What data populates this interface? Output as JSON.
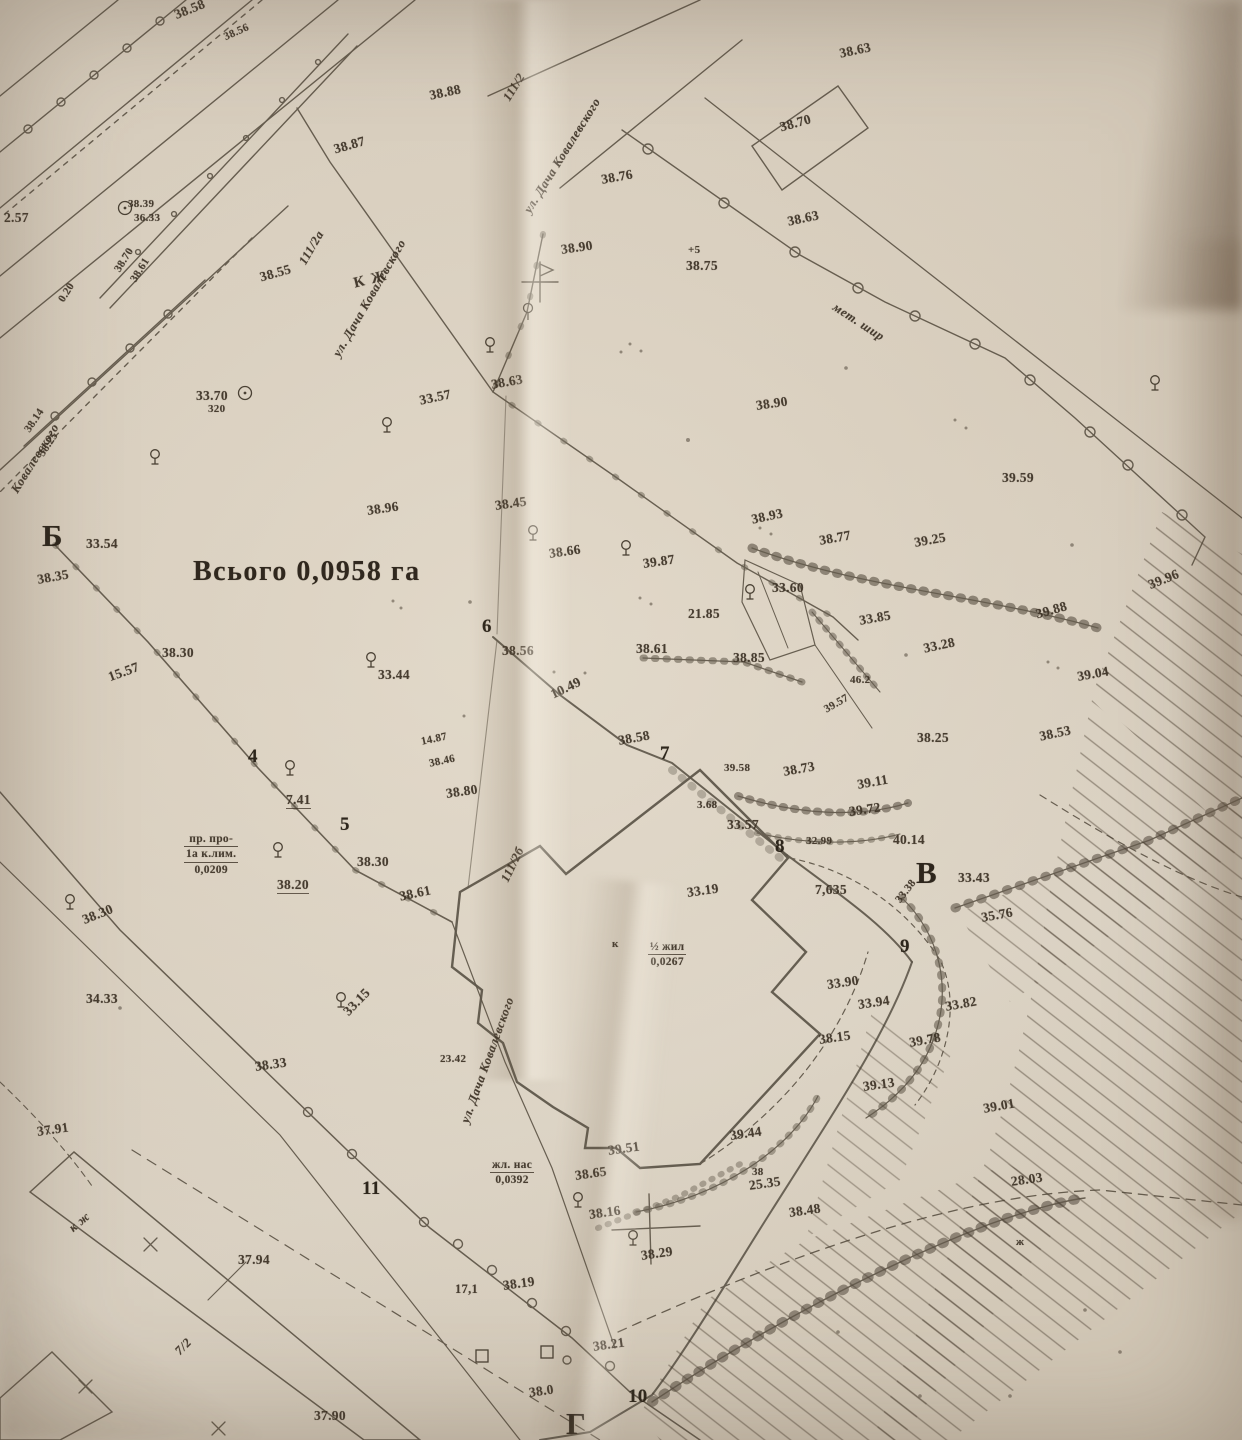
{
  "map": {
    "total_area_label": "Всього 0,0958 га",
    "labels": [
      {
        "t": "38.58",
        "x": 172,
        "y": 8,
        "r": -22
      },
      {
        "t": "38.56",
        "x": 222,
        "y": 32,
        "r": -24,
        "c": "xs"
      },
      {
        "t": "38.87",
        "x": 332,
        "y": 142,
        "r": -16
      },
      {
        "t": "38.88",
        "x": 428,
        "y": 88,
        "r": -12
      },
      {
        "t": "111/2",
        "x": 500,
        "y": 96,
        "r": -58,
        "c": "street"
      },
      {
        "t": "ул. Дача Ковалевского",
        "x": 521,
        "y": 208,
        "r": -58,
        "c": "street"
      },
      {
        "t": "111/2а",
        "x": 296,
        "y": 260,
        "r": -60,
        "c": "street"
      },
      {
        "t": "ул. Дача Ковалевского",
        "x": 330,
        "y": 352,
        "r": -60,
        "c": "street"
      },
      {
        "t": "Ковалевского",
        "x": 8,
        "y": 488,
        "r": -58,
        "c": "street"
      },
      {
        "t": "38.39",
        "x": 128,
        "y": 198,
        "c": "xs"
      },
      {
        "t": "36.33",
        "x": 134,
        "y": 212,
        "c": "xs"
      },
      {
        "t": "2.57",
        "x": 4,
        "y": 210
      },
      {
        "t": "38.70",
        "x": 112,
        "y": 268,
        "r": -58,
        "c": "xs"
      },
      {
        "t": "38.61",
        "x": 128,
        "y": 278,
        "r": -58,
        "c": "xs"
      },
      {
        "t": "0.20",
        "x": 56,
        "y": 298,
        "r": -58,
        "c": "xs"
      },
      {
        "t": "38.14",
        "x": 22,
        "y": 428,
        "r": -56,
        "c": "xs"
      },
      {
        "t": "38.25",
        "x": 36,
        "y": 452,
        "r": -56,
        "c": "xs"
      },
      {
        "t": "33.70",
        "x": 196,
        "y": 388
      },
      {
        "t": "320",
        "x": 208,
        "y": 403,
        "c": "xs"
      },
      {
        "t": "38.55",
        "x": 258,
        "y": 270,
        "r": -16
      },
      {
        "t": "КЖ",
        "x": 352,
        "y": 276,
        "r": -14,
        "c": "kz"
      },
      {
        "t": "Б",
        "x": 42,
        "y": 518,
        "c": "ltr"
      },
      {
        "t": "33.54",
        "x": 86,
        "y": 536
      },
      {
        "t": "38.35",
        "x": 36,
        "y": 572,
        "r": -10
      },
      {
        "t": "38.76",
        "x": 600,
        "y": 172,
        "r": -10
      },
      {
        "t": "38.70",
        "x": 778,
        "y": 120,
        "r": -16
      },
      {
        "t": "38.63",
        "x": 786,
        "y": 214,
        "r": -12
      },
      {
        "t": "38.63",
        "x": 838,
        "y": 46,
        "r": -12
      },
      {
        "t": "38.90",
        "x": 560,
        "y": 242,
        "r": -8
      },
      {
        "t": "+5",
        "x": 688,
        "y": 244,
        "c": "xs"
      },
      {
        "t": "38.75",
        "x": 686,
        "y": 258
      },
      {
        "t": "мет. шир",
        "x": 838,
        "y": 300,
        "r": 33,
        "c": "street"
      },
      {
        "t": "38.90",
        "x": 755,
        "y": 398,
        "r": -8
      },
      {
        "t": "39.59",
        "x": 1002,
        "y": 470
      },
      {
        "t": "33.57",
        "x": 418,
        "y": 393,
        "r": -12
      },
      {
        "t": "38.63",
        "x": 490,
        "y": 377,
        "r": -10
      },
      {
        "t": "38.96",
        "x": 366,
        "y": 503,
        "r": -8
      },
      {
        "t": "38.45",
        "x": 494,
        "y": 498,
        "r": -8
      },
      {
        "t": "38.66",
        "x": 548,
        "y": 546,
        "r": -8
      },
      {
        "t": "39.87",
        "x": 642,
        "y": 556,
        "r": -8
      },
      {
        "t": "38.93",
        "x": 750,
        "y": 512,
        "r": -12
      },
      {
        "t": "38.77",
        "x": 818,
        "y": 533,
        "r": -10
      },
      {
        "t": "39.25",
        "x": 913,
        "y": 535,
        "r": -10
      },
      {
        "t": "33.60",
        "x": 772,
        "y": 580
      },
      {
        "t": "21.85",
        "x": 688,
        "y": 606
      },
      {
        "t": "38.61",
        "x": 636,
        "y": 641
      },
      {
        "t": "38.85",
        "x": 733,
        "y": 650
      },
      {
        "t": "33.85",
        "x": 858,
        "y": 613,
        "r": -10
      },
      {
        "t": "33.28",
        "x": 922,
        "y": 641,
        "r": -12
      },
      {
        "t": "39.88",
        "x": 1034,
        "y": 607,
        "r": -16
      },
      {
        "t": "39.96",
        "x": 1146,
        "y": 578,
        "r": -22
      },
      {
        "t": "39.04",
        "x": 1076,
        "y": 669,
        "r": -10
      },
      {
        "t": "46.2",
        "x": 850,
        "y": 674,
        "c": "xs"
      },
      {
        "t": "38.25",
        "x": 917,
        "y": 730
      },
      {
        "t": "38.53",
        "x": 1038,
        "y": 729,
        "r": -12
      },
      {
        "t": "39.57",
        "x": 822,
        "y": 705,
        "r": -30,
        "c": "xs"
      },
      {
        "t": "38.30",
        "x": 162,
        "y": 645
      },
      {
        "t": "15.57",
        "x": 106,
        "y": 670,
        "r": -20
      },
      {
        "t": "33.44",
        "x": 378,
        "y": 667
      },
      {
        "t": "6",
        "x": 482,
        "y": 616,
        "c": "pt"
      },
      {
        "t": "38.56",
        "x": 502,
        "y": 643
      },
      {
        "t": "10.49",
        "x": 548,
        "y": 688,
        "r": -26
      },
      {
        "t": "38.58",
        "x": 617,
        "y": 733,
        "r": -10
      },
      {
        "t": "7",
        "x": 660,
        "y": 743,
        "c": "pt"
      },
      {
        "t": "39.58",
        "x": 724,
        "y": 762,
        "c": "xs"
      },
      {
        "t": "38.73",
        "x": 782,
        "y": 764,
        "r": -10
      },
      {
        "t": "39.11",
        "x": 856,
        "y": 777,
        "r": -10
      },
      {
        "t": "39.72",
        "x": 848,
        "y": 804,
        "r": -8
      },
      {
        "t": "3.68",
        "x": 697,
        "y": 799,
        "c": "xs"
      },
      {
        "t": "33.57",
        "x": 727,
        "y": 817
      },
      {
        "t": "32.99",
        "x": 806,
        "y": 835,
        "c": "xs"
      },
      {
        "t": "40.14",
        "x": 893,
        "y": 832
      },
      {
        "t": "4",
        "x": 248,
        "y": 746,
        "c": "pt"
      },
      {
        "t": "7.41",
        "x": 286,
        "y": 792,
        "c": "u"
      },
      {
        "t": "14.87",
        "x": 420,
        "y": 736,
        "r": -12,
        "c": "xs"
      },
      {
        "t": "38.46",
        "x": 428,
        "y": 758,
        "r": -12,
        "c": "xs"
      },
      {
        "t": "5",
        "x": 340,
        "y": 814,
        "c": "pt"
      },
      {
        "t": "38.30",
        "x": 357,
        "y": 854
      },
      {
        "t": "38.20",
        "x": 277,
        "y": 877,
        "c": "u"
      },
      {
        "t": "38.61",
        "x": 398,
        "y": 889,
        "r": -12
      },
      {
        "t": "38.80",
        "x": 445,
        "y": 786,
        "r": -8
      },
      {
        "lines": [
          "пр. про-",
          "1а к.лим.",
          "0,0209"
        ],
        "x": 184,
        "y": 832,
        "c": "blk"
      },
      {
        "t": "8",
        "x": 775,
        "y": 836,
        "c": "pt"
      },
      {
        "t": "33.19",
        "x": 686,
        "y": 885,
        "r": -8
      },
      {
        "t": "7,635",
        "x": 815,
        "y": 882
      },
      {
        "t": "В",
        "x": 916,
        "y": 855,
        "c": "ltr"
      },
      {
        "t": "33.43",
        "x": 958,
        "y": 870
      },
      {
        "t": "33.38",
        "x": 893,
        "y": 898,
        "r": -52,
        "c": "xs"
      },
      {
        "t": "35.76",
        "x": 980,
        "y": 910,
        "r": -10
      },
      {
        "t": "9",
        "x": 900,
        "y": 936,
        "c": "pt"
      },
      {
        "t": "33.90",
        "x": 826,
        "y": 977,
        "r": -8
      },
      {
        "t": "33.94",
        "x": 857,
        "y": 997,
        "r": -8
      },
      {
        "t": "33.82",
        "x": 944,
        "y": 999,
        "r": -10
      },
      {
        "t": "38.15",
        "x": 818,
        "y": 1032,
        "r": -8
      },
      {
        "t": "39.78",
        "x": 908,
        "y": 1035,
        "r": -10
      },
      {
        "t": "39.13",
        "x": 862,
        "y": 1079,
        "r": -8
      },
      {
        "t": "39.01",
        "x": 982,
        "y": 1101,
        "r": -10
      },
      {
        "t": "28.03",
        "x": 1010,
        "y": 1174,
        "r": -8
      },
      {
        "lines": [
          "½ жил",
          "0,0267"
        ],
        "x": 648,
        "y": 940,
        "c": "blk"
      },
      {
        "t": "к",
        "x": 612,
        "y": 938,
        "c": "xs"
      },
      {
        "t": "38.30",
        "x": 80,
        "y": 913,
        "r": -22
      },
      {
        "t": "34.33",
        "x": 86,
        "y": 991
      },
      {
        "t": "33.15",
        "x": 340,
        "y": 1008,
        "r": -46
      },
      {
        "t": "38.33",
        "x": 254,
        "y": 1059,
        "r": -8
      },
      {
        "t": "37.91",
        "x": 36,
        "y": 1124,
        "r": -8
      },
      {
        "t": "23.42",
        "x": 440,
        "y": 1053,
        "c": "xs"
      },
      {
        "t": "11",
        "x": 362,
        "y": 1178,
        "c": "pt"
      },
      {
        "t": "37.94",
        "x": 238,
        "y": 1252
      },
      {
        "t": "к ж",
        "x": 66,
        "y": 1224,
        "r": -40,
        "c": "street"
      },
      {
        "t": "7/2",
        "x": 172,
        "y": 1348,
        "r": -46,
        "c": "street"
      },
      {
        "t": "37.90",
        "x": 314,
        "y": 1408
      },
      {
        "t": "39.51",
        "x": 607,
        "y": 1143,
        "r": -8
      },
      {
        "t": "38.65",
        "x": 574,
        "y": 1168,
        "r": -8
      },
      {
        "lines": [
          "жл. нас",
          "0,0392"
        ],
        "x": 490,
        "y": 1158,
        "c": "blk"
      },
      {
        "t": "38.16",
        "x": 588,
        "y": 1207,
        "r": -8
      },
      {
        "t": "38.29",
        "x": 640,
        "y": 1248,
        "r": -8
      },
      {
        "t": "39.44",
        "x": 729,
        "y": 1128,
        "r": -8
      },
      {
        "t": "38",
        "x": 752,
        "y": 1166,
        "c": "xs"
      },
      {
        "t": "25.35",
        "x": 748,
        "y": 1178,
        "r": -8
      },
      {
        "t": "38.48",
        "x": 788,
        "y": 1205,
        "r": -8
      },
      {
        "t": "17,1",
        "x": 455,
        "y": 1282,
        "c": "md"
      },
      {
        "t": "38.19",
        "x": 502,
        "y": 1278,
        "r": -8
      },
      {
        "t": "38.21",
        "x": 592,
        "y": 1339,
        "r": -8
      },
      {
        "t": "38.0",
        "x": 528,
        "y": 1385,
        "r": -8
      },
      {
        "t": "10",
        "x": 628,
        "y": 1386,
        "c": "pt"
      },
      {
        "t": "Г",
        "x": 566,
        "y": 1406,
        "c": "ltr"
      },
      {
        "t": "ул. Дача Ковалевского",
        "x": 458,
        "y": 1120,
        "r": -70,
        "c": "street"
      },
      {
        "t": "111/2б",
        "x": 498,
        "y": 878,
        "r": -64,
        "c": "street"
      },
      {
        "t": "ж",
        "x": 1016,
        "y": 1236,
        "c": "xs"
      }
    ],
    "symbols": {
      "trees": [
        [
          155,
          460
        ],
        [
          387,
          428
        ],
        [
          490,
          348
        ],
        [
          533,
          536
        ],
        [
          626,
          551
        ],
        [
          371,
          663
        ],
        [
          290,
          771
        ],
        [
          278,
          853
        ],
        [
          70,
          905
        ],
        [
          341,
          1003
        ],
        [
          578,
          1203
        ],
        [
          633,
          1241
        ],
        [
          1155,
          386
        ],
        [
          750,
          595
        ]
      ],
      "circled_points": [
        [
          125,
          208
        ],
        [
          245,
          393
        ]
      ],
      "fence_posts": [
        [
          528,
          308
        ]
      ],
      "squares": [
        [
          482,
          1356
        ],
        [
          547,
          1352
        ]
      ]
    }
  }
}
